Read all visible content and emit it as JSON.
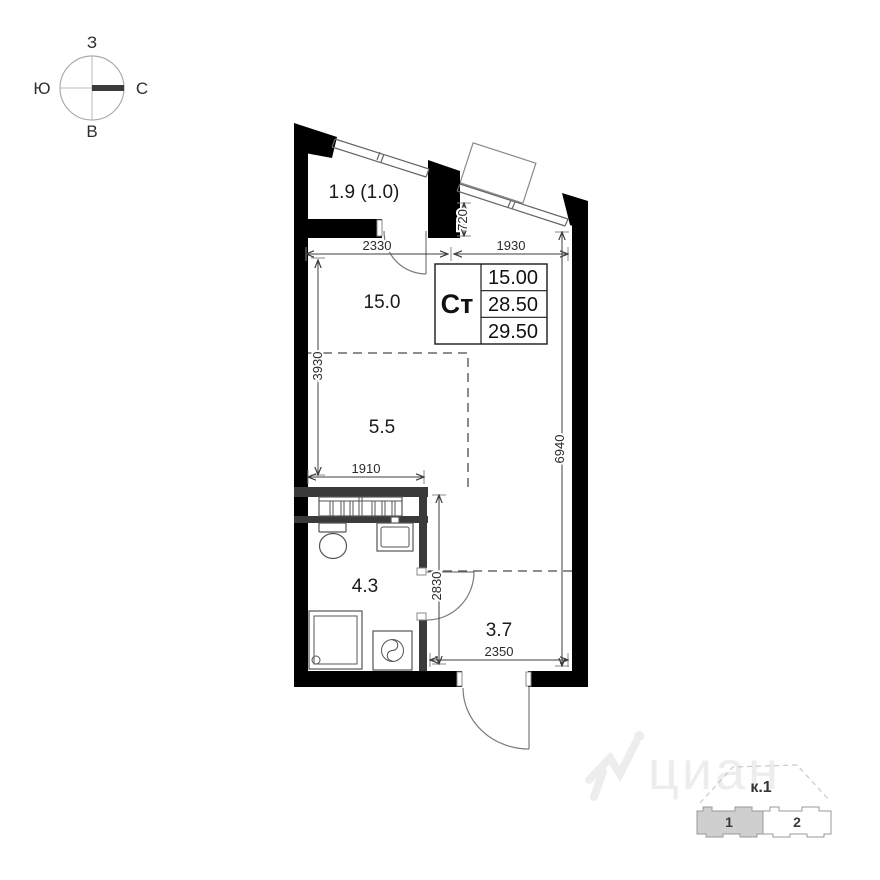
{
  "compass": {
    "west": "З",
    "south": "Ю",
    "north": "С",
    "east": "В"
  },
  "rooms": [
    {
      "id": "balcony",
      "area": "1.9 (1.0)"
    },
    {
      "id": "living",
      "area": "15.0"
    },
    {
      "id": "kitchen_niche",
      "area": "5.5"
    },
    {
      "id": "bathroom",
      "area": "4.3"
    },
    {
      "id": "hallway",
      "area": "3.7"
    }
  ],
  "dimensions_mm": {
    "balcony_width": "2330",
    "window_width": "1930",
    "window_depth": "720",
    "living_depth": "3930",
    "apartment_depth": "6940",
    "kitchen_width": "1910",
    "hallway_depth": "2830",
    "hallway_width": "2350"
  },
  "info_table": {
    "type": "Ст",
    "rows": [
      "15.00",
      "28.50",
      "29.50"
    ]
  },
  "watermark": "циан",
  "site_plan": {
    "building": "к.1",
    "sections": [
      "1",
      "2"
    ]
  },
  "colors": {
    "wall": "#000000",
    "inner_wall": "#3a3a3a",
    "thin_line": "#666666",
    "dim_text": "#2b2b2b",
    "section_highlight": "#cfcfcf",
    "watermark": "#ededed"
  }
}
